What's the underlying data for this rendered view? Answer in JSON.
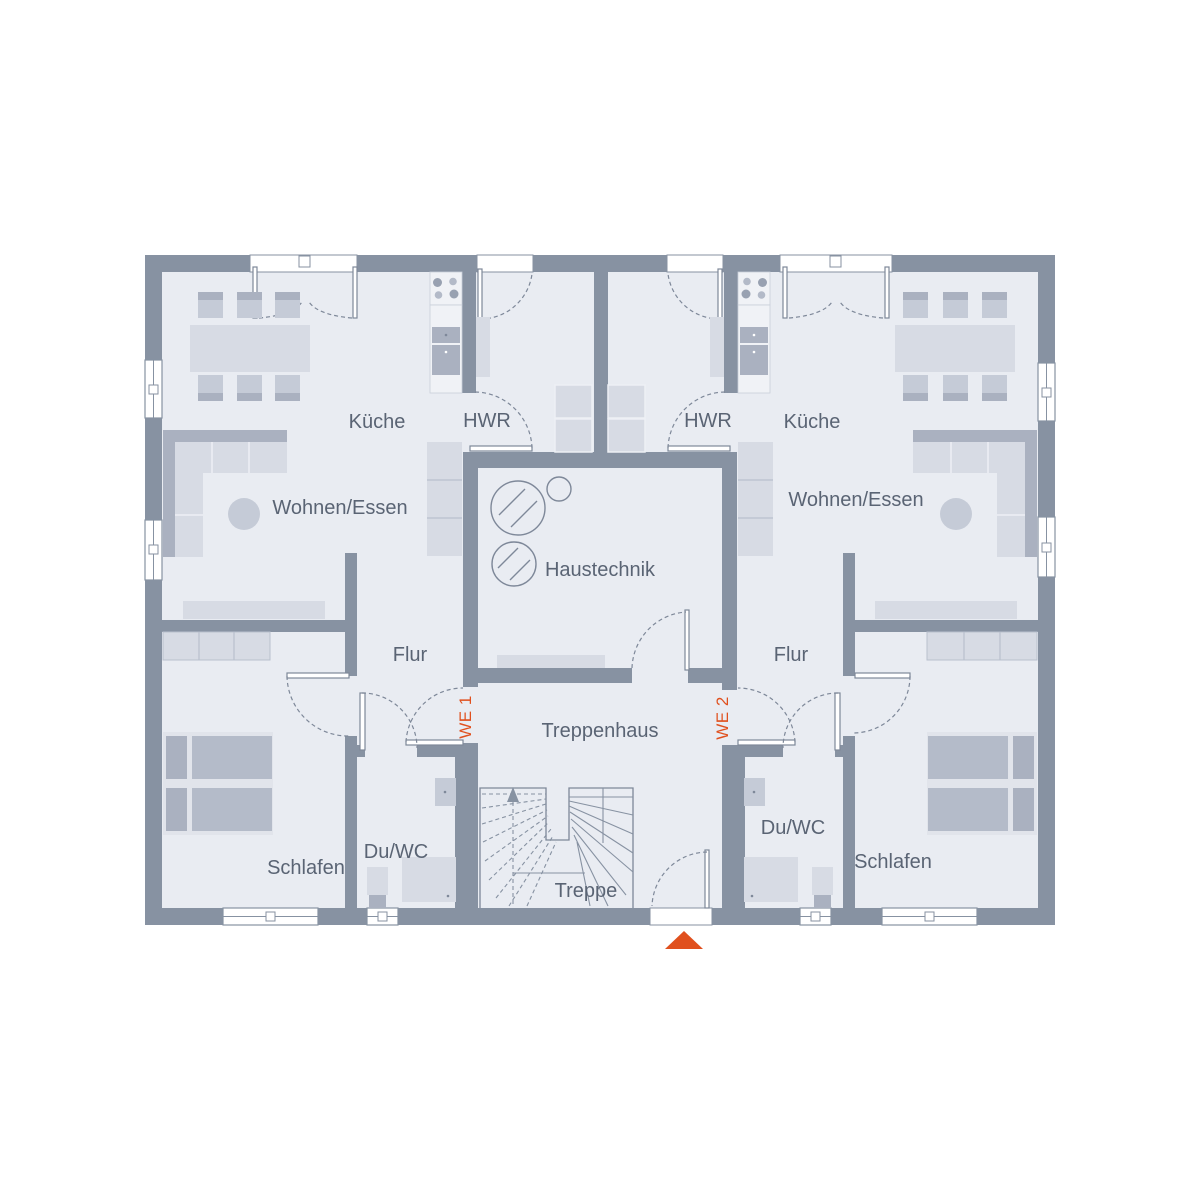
{
  "plan": {
    "units": {
      "we1": {
        "label": "WE 1"
      },
      "we2": {
        "label": "WE 2"
      }
    },
    "rooms": {
      "left": {
        "kitchen": "Küche",
        "utility": "HWR",
        "living": "Wohnen/Essen",
        "hallway": "Flur",
        "bedroom": "Schlafen",
        "bath": "Du/WC"
      },
      "right": {
        "kitchen": "Küche",
        "utility": "HWR",
        "living": "Wohnen/Essen",
        "hallway": "Flur",
        "bedroom": "Schlafen",
        "bath": "Du/WC"
      },
      "core": {
        "mechanical": "Haustechnik",
        "stair_hall": "Treppenhaus",
        "stair": "Treppe"
      }
    },
    "colors": {
      "background": "#ffffff",
      "wall": "#8792a2",
      "floor": "#e9ecf2",
      "furniture-light": "#d7dbe4",
      "furniture-mid": "#c5cbd7",
      "furniture-dark": "#aab1c0",
      "line": "#7e8899",
      "text": "#5a6474",
      "accent": "#e0501e"
    }
  }
}
